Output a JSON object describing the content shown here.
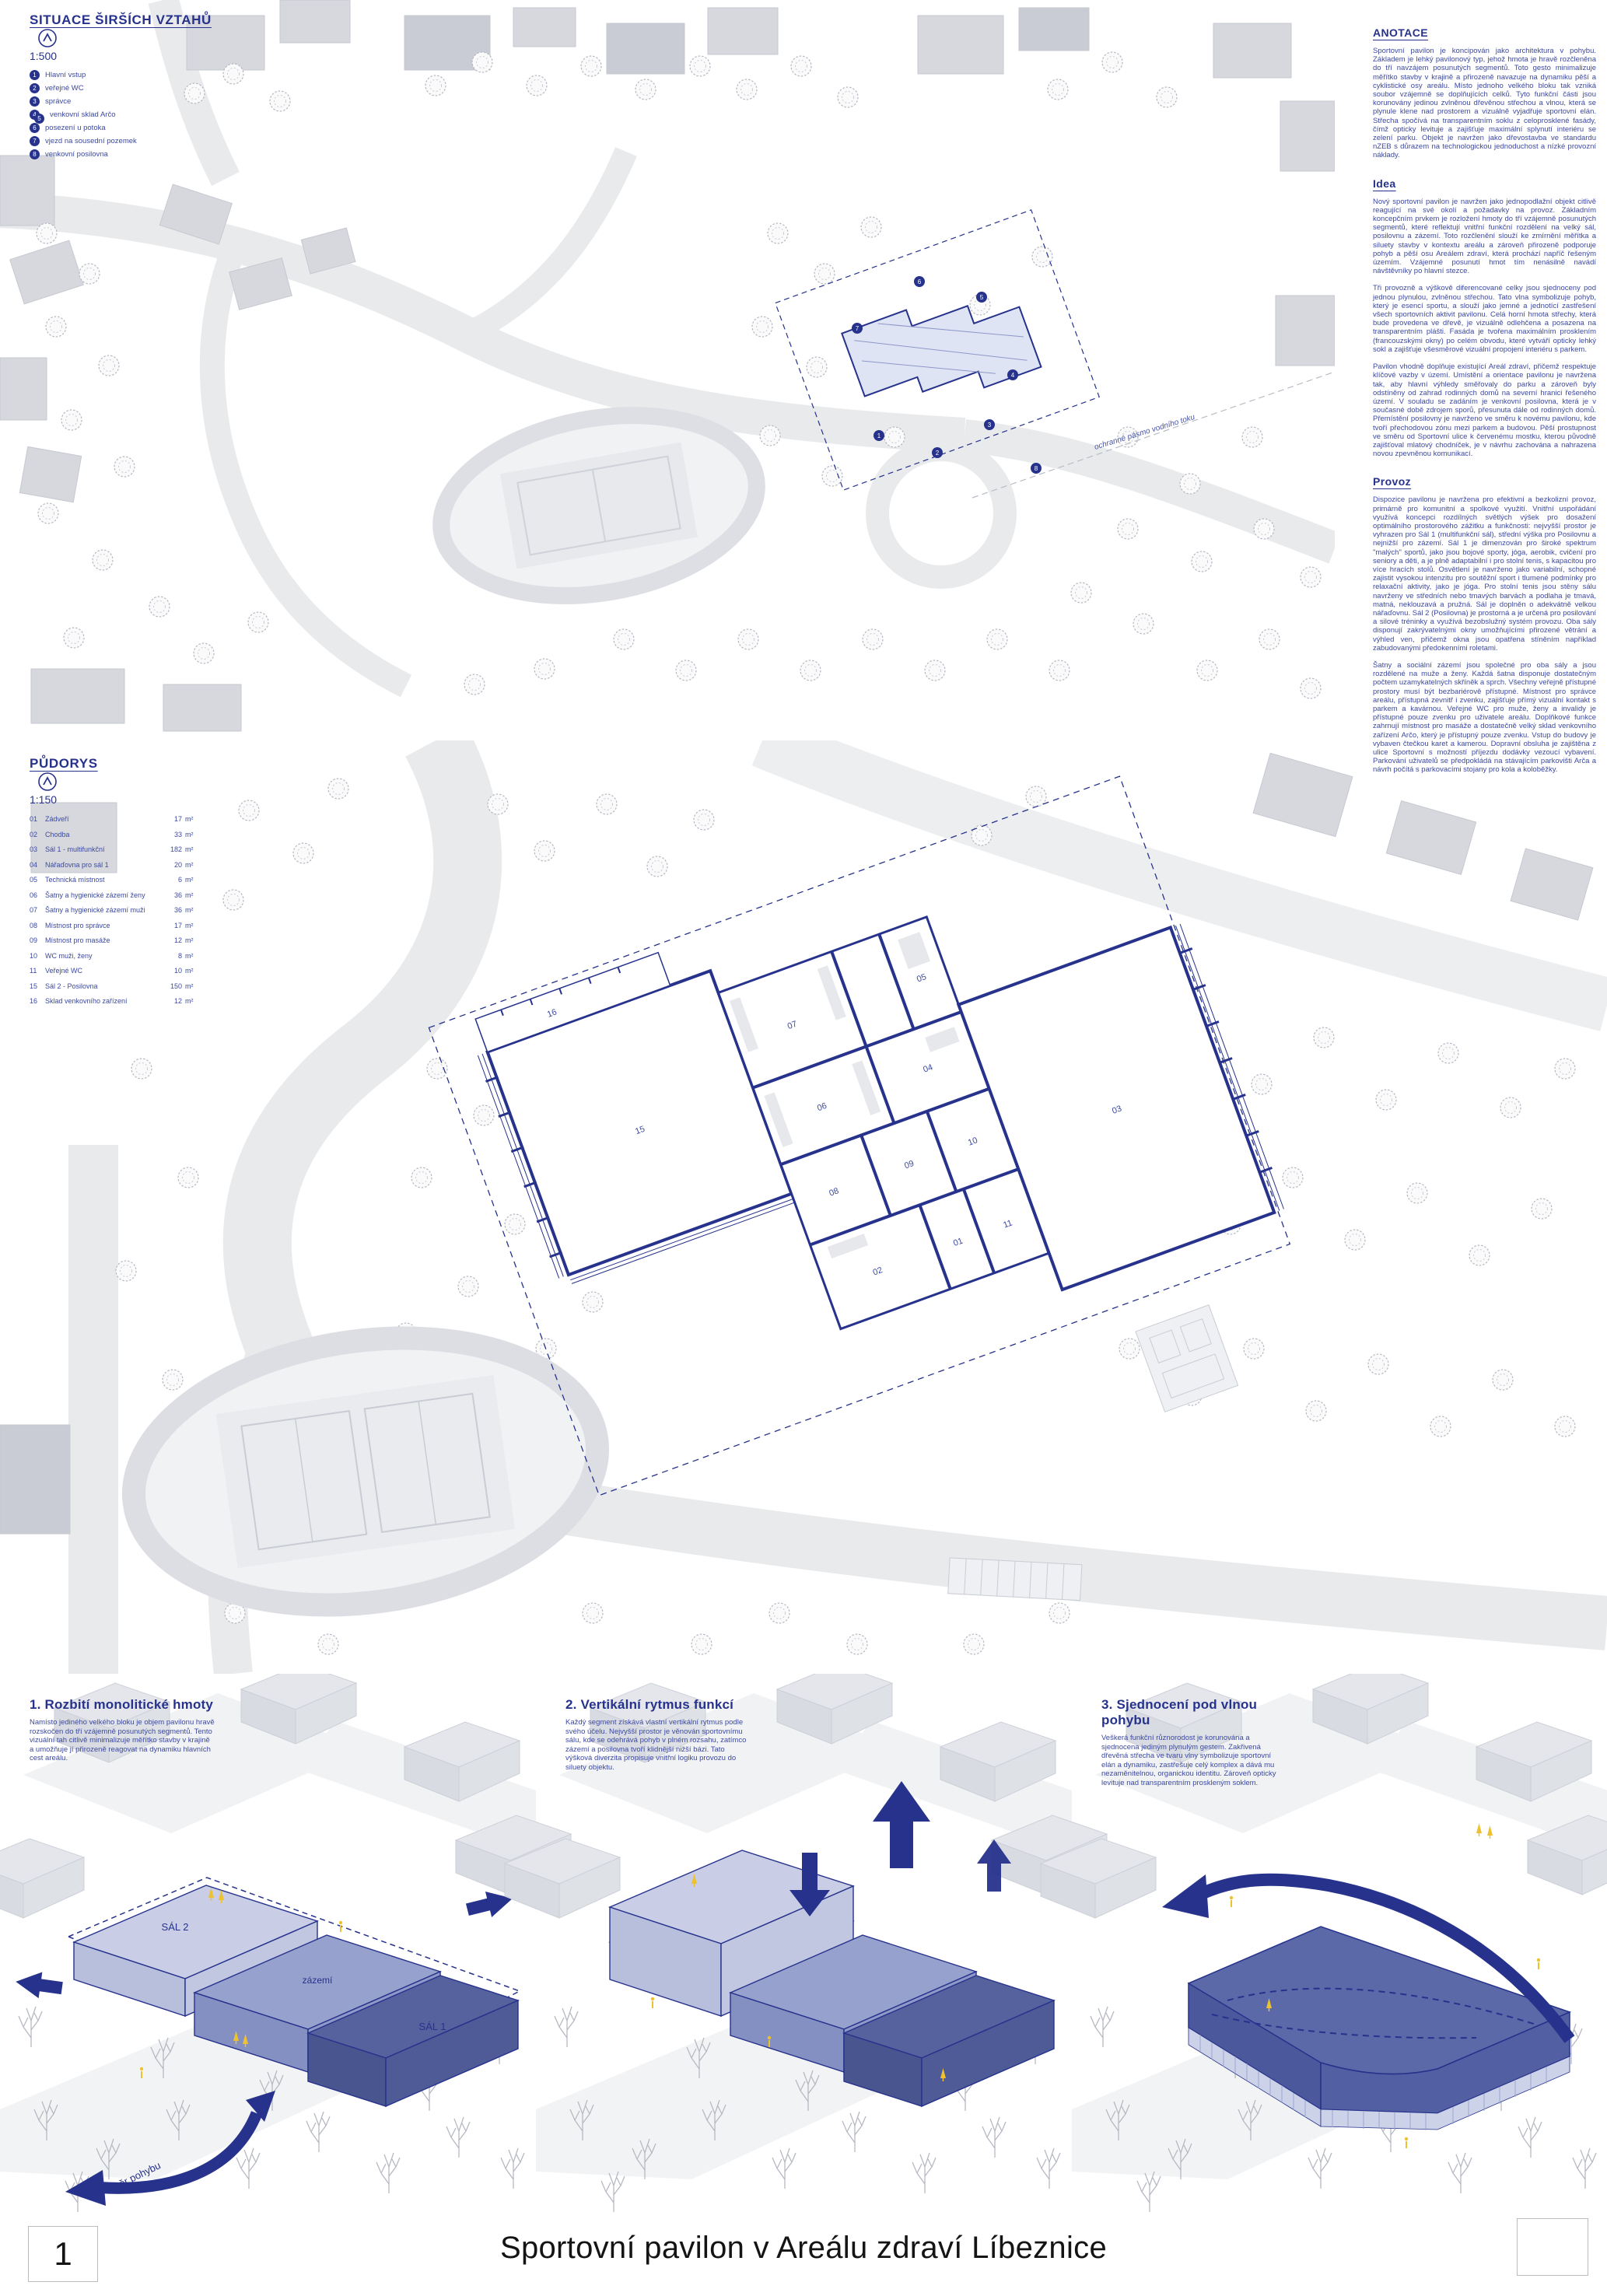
{
  "colors": {
    "accent_navy": "#26328c",
    "body_blue": "#3c49a0",
    "box_light": "#c9cee6",
    "box_medium": "#96a1cd",
    "box_dark": "#55629e",
    "highlight_yellow": "#eec12f",
    "map_gray": "#d7d9de",
    "black": "#141414"
  },
  "situace": {
    "title": "SITUACE ŠIRŠÍCH VZTAHŮ",
    "scale": "1:500",
    "items": [
      {
        "badges": [
          "1"
        ],
        "label": "Hlavní vstup"
      },
      {
        "badges": [
          "2"
        ],
        "label": "veřejné WC"
      },
      {
        "badges": [
          "3"
        ],
        "label": "správce"
      },
      {
        "badges": [
          "4",
          "5"
        ],
        "label": "venkovní sklad Arčo"
      },
      {
        "badges": [
          "6"
        ],
        "label": "posezení u potoka"
      },
      {
        "badges": [
          "7"
        ],
        "label": "vjezd na sousední pozemek"
      },
      {
        "badges": [
          "8"
        ],
        "label": "venkovní posilovna"
      }
    ]
  },
  "map_labels": {
    "protection_line": "ochranné pásmo vodního toku"
  },
  "anotace": {
    "heading": "ANOTACE",
    "p1": "Sportovní pavilon je koncipován jako architektura v pohybu. Základem je lehký pavilonový typ, jehož hmota je hravě rozčleněna do tří navzájem posunutých segmentů. Toto gesto minimalizuje měřítko stavby v krajině a přirozeně navazuje na dynamiku pěší a cyklistické osy areálu. Místo jednoho velkého bloku tak vzniká soubor vzájemně se doplňujících celků. Tyto funkční části jsou korunovány jedinou zvlněnou dřevěnou střechou a vlnou, která se plynule klene nad prostorem a vizuálně vyjadřuje sportovní elán. Střecha spočívá na transparentním soklu z celoprosklené fasády, čímž opticky levituje a zajišťuje maximální splynutí interiéru se zelení parku. Objekt je navržen jako dřevostavba ve standardu nZEB s důrazem na technologickou jednoduchost a nízké provozní náklady."
  },
  "idea": {
    "heading": "Idea",
    "p1": "Nový sportovní pavilon je navržen jako jednopodlažní objekt citlivě reagující na své okolí a požadavky na provoz. Základním koncepčním prvkem je rozložení hmoty do tří vzájemně posunutých segmentů, které reflektují vnitřní funkční rozdělení na velký sál, posilovnu a zázemí. Toto rozčlenění slouží ke zmírnění měřítka a siluety stavby v kontextu areálu a zároveň přirozeně podporuje pohyb a pěší osu Areálem zdraví, která prochází napříč řešeným územím. Vzájemné posunutí hmot tím nenásilně navádí návštěvníky po hlavní stezce.",
    "p2": "Tři provozně a výškově diferencované celky jsou sjednoceny pod jednou plynulou, zvlněnou střechou. Tato vlna symbolizuje pohyb, který je esencí sportu, a slouží jako jemné a jednotící zastřešení všech sportovních aktivit pavilonu. Celá horní hmota střechy, která bude provedena ve dřevě, je vizuálně odlehčena a posazena na transparentním plášti. Fasáda je tvořena maximálním prosklením (francouzskými okny) po celém obvodu, které vytváří opticky lehký sokl a zajišťuje všesměrové vizuální propojení interiéru s parkem.",
    "p3": "Pavilon vhodně doplňuje existující Areál zdraví, přičemž respektuje klíčové vazby v území. Umístění a orientace pavilonu je navržena tak, aby hlavní výhledy směřovaly do parku a zároveň byly odstíněny od zahrad rodinných domů na severní hranici řešeného území. V souladu se zadáním je venkovní posilovna, která je v současné době zdrojem sporů, přesunuta dále od rodinných domů. Přemístění posilovny je navrženo ve směru k novému pavilonu, kde tvoří přechodovou zónu mezi parkem a budovou. Pěší prostupnost ve směru od Sportovní ulice k červenému mostku, kterou původně zajišťoval mlatový chodníček, je v návrhu zachována a nahrazena novou zpevněnou komunikací."
  },
  "provoz": {
    "heading": "Provoz",
    "p1": "Dispozice pavilonu je navržena pro efektivní a bezkolizní provoz, primárně pro komunitní a spolkové využití. Vnitřní uspořádání využívá koncepci rozdílných světlých výšek pro dosažení optimálního prostorového zážitku a funkčnosti: nejvyšší prostor je vyhrazen pro Sál 1 (multifunkční sál), střední výška pro Posilovnu a nejnižší pro zázemí. Sál 1 je dimenzován pro široké spektrum \"malých\" sportů, jako jsou bojové sporty, jóga, aerobik, cvičení pro seniory a děti, a je plně adaptabilní i pro stolní tenis, s kapacitou pro více hracích stolů. Osvětlení je navrženo jako variabilní, schopné zajistit vysokou intenzitu pro soutěžní sport i tlumené podmínky pro relaxační aktivity, jako je jóga. Pro stolní tenis jsou stěny sálu navrženy ve středních nebo tmavých barvách a podlaha je tmavá, matná, neklouzavá a pružná. Sál je doplněn o adekvátně velkou nářaďovnu. Sál 2 (Posilovna) je prostorná a je určená pro posilování a silové tréninky a využívá bezobslužný systém provozu. Oba sály disponují zakrývatelnými okny umožňujícími přirozené větrání a výhled ven, přičemž okna jsou opatřena stíněním například zabudovanými předokenními roletami.",
    "p2": "Šatny a sociální zázemí jsou společné pro oba sály a jsou rozdělené na muže a ženy. Každá šatna disponuje dostatečným počtem uzamykatelných skříněk a sprch. Všechny veřejně přístupné prostory musí být bezbariérově přístupné. Místnost pro správce areálu, přístupná zevnitř i zvenku, zajišťuje přímý vizuální kontakt s parkem a kavárnou. Veřejné WC pro muže, ženy a invalidy je přístupné pouze zvenku pro uživatele areálu. Doplňkové funkce zahrnují místnost pro masáže a dostatečně velký sklad venkovního zařízení Arčo, který je přístupný pouze zvenku. Vstup do budovy je vybaven čtečkou karet a kamerou. Dopravní obsluha je zajištěna z ulice Sportovní s možností příjezdu dodávky vezoucí vybavení. Parkování uživatelů se předpokládá na stávajícím parkovišti Arča a návrh počítá s parkovacími stojany pro kola a koloběžky."
  },
  "pudorys": {
    "title": "PŮDORYS",
    "scale": "1:150",
    "unit": "m²",
    "rooms": [
      {
        "num": "01",
        "name": "Zádveří",
        "area": "17"
      },
      {
        "num": "02",
        "name": "Chodba",
        "area": "33"
      },
      {
        "num": "03",
        "name": "Sál 1 - multifunkční",
        "area": "182"
      },
      {
        "num": "04",
        "name": "Nářaďovna pro sál 1",
        "area": "20"
      },
      {
        "num": "05",
        "name": "Technická místnost",
        "area": "6"
      },
      {
        "num": "06",
        "name": "Šatny a hygienické zázemí ženy",
        "area": "36"
      },
      {
        "num": "07",
        "name": "Šatny a hygienické zázemí muži",
        "area": "36"
      },
      {
        "num": "08",
        "name": "Místnost pro správce",
        "area": "17"
      },
      {
        "num": "09",
        "name": "Místnost pro masáže",
        "area": "12"
      },
      {
        "num": "10",
        "name": "WC muži, ženy",
        "area": "8"
      },
      {
        "num": "11",
        "name": "Veřejné WC",
        "area": "10"
      },
      {
        "num": "15",
        "name": "Sál 2 - Posilovna",
        "area": "150"
      },
      {
        "num": "16",
        "name": "Sklad venkovního zařízení",
        "area": "12"
      }
    ]
  },
  "diagrams": [
    {
      "heading": "1. Rozbití monolitické hmoty",
      "text": "Namísto jediného velkého bloku je objem pavilonu hravě rozskočen do tří vzájemně posunutých segmentů. Tento vizuální tah citlivě minimalizuje měřítko stavby v krajině a umožňuje jí přirozeně reagovat na dynamiku hlavních cest areálu.",
      "labels": {
        "sal2": "SÁL 2",
        "zazemi": "zázemí",
        "sal1": "SÁL 1",
        "arrow": "směr pohybu"
      }
    },
    {
      "heading": "2. Vertikální rytmus funkcí",
      "text": "Každý segment získává vlastní vertikální rytmus podle svého účelu. Nejvyšší prostor je věnován sportovnímu sálu, kde se odehrává pohyb v plném rozsahu, zatímco zázemí a posilovna tvoří klidnější nižší bázi. Tato výšková diverzita propisuje vnitřní logiku provozu do siluety objektu."
    },
    {
      "heading": "3. Sjednocení pod vlnou pohybu",
      "text": "Veškerá funkční různorodost je korunována a sjednocena jediným plynulým gestem. Zakřivená dřevěná střecha ve tvaru vlny symbolizuje sportovní elán a dynamiku, zastřešuje celý komplex a dává mu nezaměnitelnou, organickou identitu. Zároveň opticky levituje nad transparentním proskleným soklem."
    }
  ],
  "footer": {
    "page_number": "1",
    "title": "Sportovní pavilon v Areálu zdraví Líbeznice"
  }
}
